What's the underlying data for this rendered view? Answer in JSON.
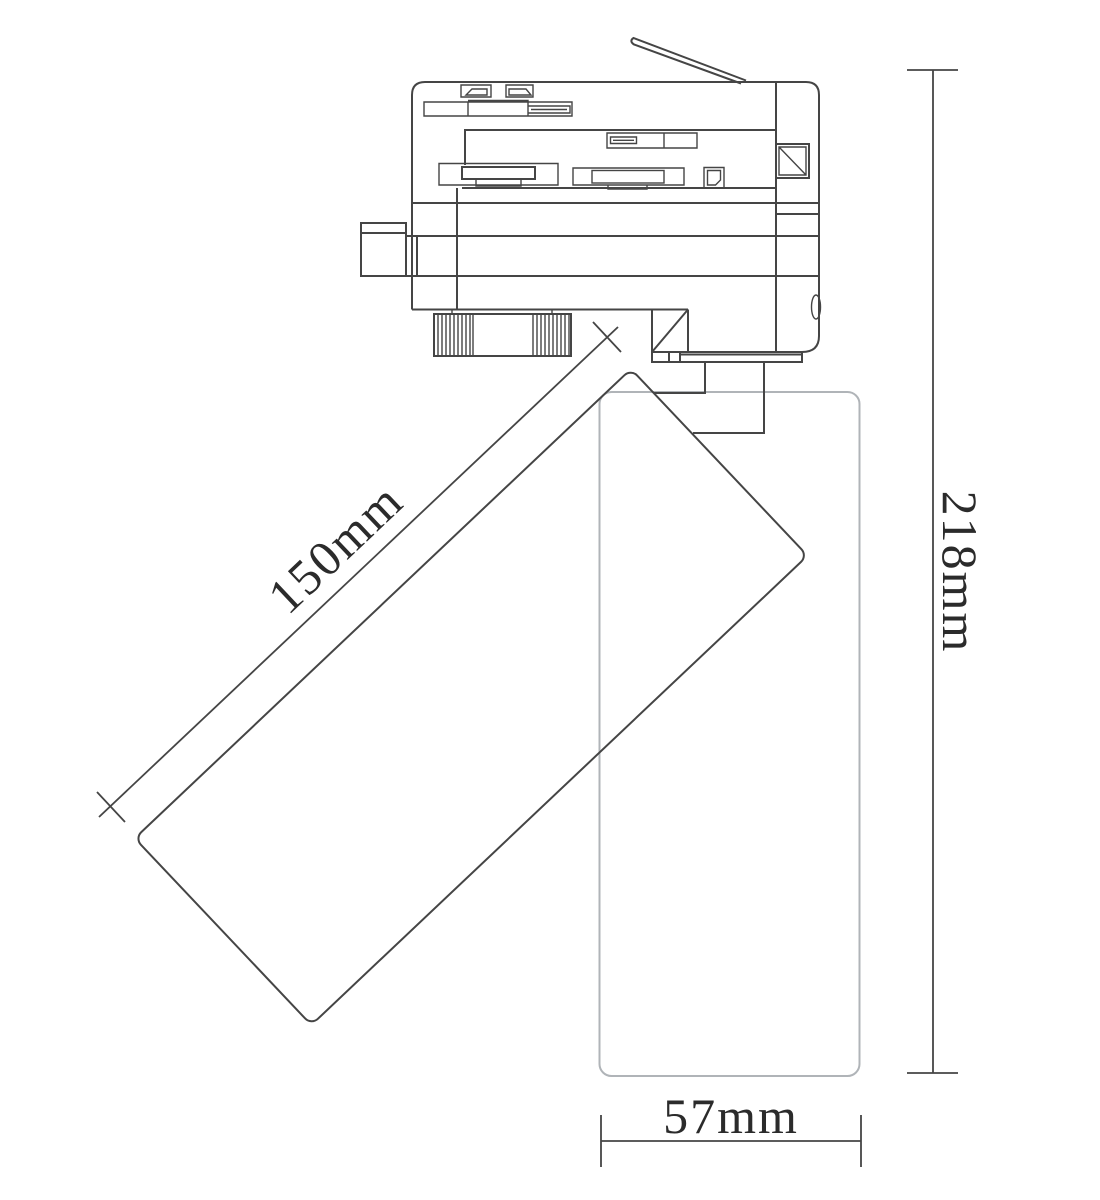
{
  "drawing": {
    "description": "Track spotlight technical line drawing",
    "dimensions": {
      "body_length": "150mm",
      "overall_height": "218mm",
      "body_width": "57mm"
    },
    "colors": {
      "line": "#454545",
      "ghost_line": "#b0b4b8",
      "text": "#2b2b2b",
      "background": "#ffffff"
    }
  }
}
